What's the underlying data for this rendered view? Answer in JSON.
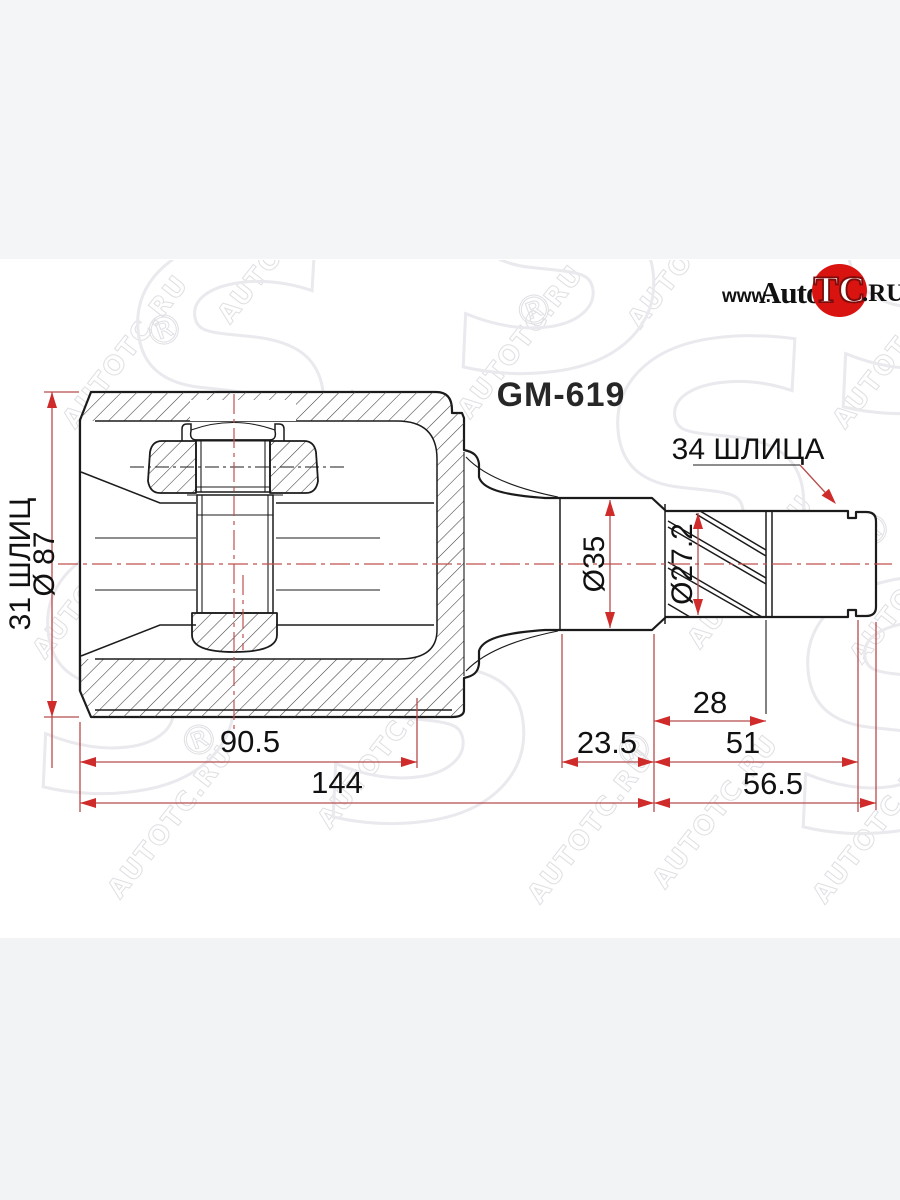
{
  "part_code": "GM-619",
  "logo": {
    "www": "www.",
    "auto": "Auto",
    "tc": "TC",
    "ru": ".RU",
    "circle_color": "#d9130f"
  },
  "drawing": {
    "labels": {
      "splines_left": "31 ШЛИЦ",
      "dia_housing": "Ø 87",
      "dia_body": "Ø35",
      "dia_spline": "Ø27.2",
      "splines_right": "34 ШЛИЦА"
    },
    "dims": {
      "spline_len": "28",
      "neck_len": "23.5",
      "stub_len": "51",
      "tip_len": "56.5",
      "housing_depth": "90.5",
      "total_len": "144"
    },
    "colors": {
      "dim_line": "#b84c4c",
      "arrow": "#cf2b2b",
      "outline": "#1b1b1b"
    }
  },
  "watermark": {
    "text": "AUTOTC.RU",
    "reg": "®",
    "big": "S"
  }
}
